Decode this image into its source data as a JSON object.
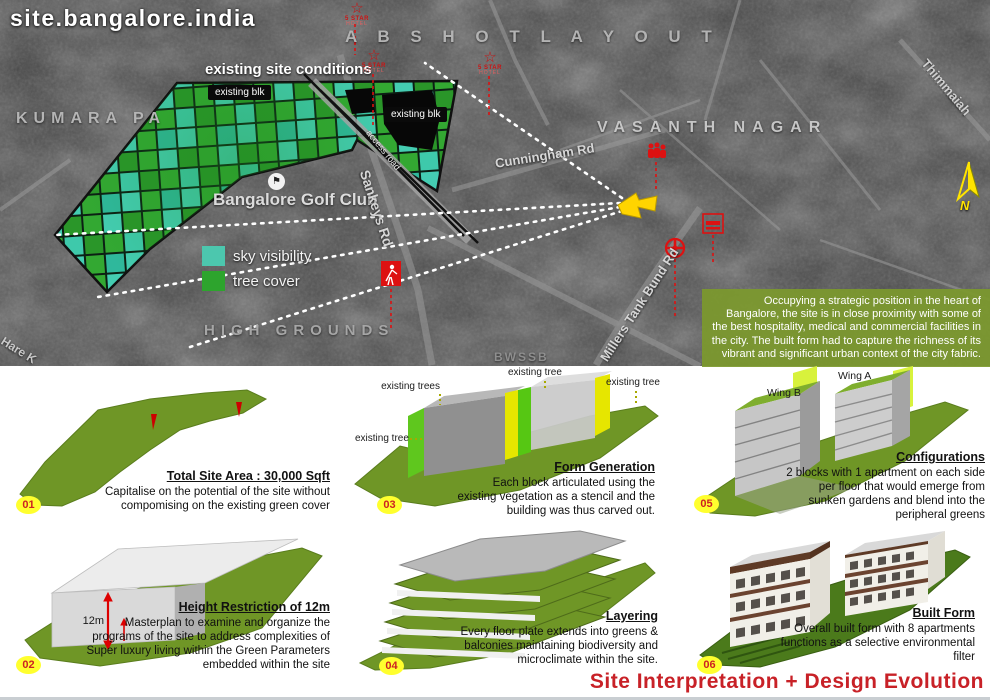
{
  "title": "site.bangalore.india",
  "map": {
    "overlay_title": "existing site conditions",
    "areas": {
      "abshot": "A B S H O T   L A Y O U T",
      "vasanth": "VASANTH NAGAR",
      "kumara": "KUMARA PA",
      "high_grounds": "HIGH GROUNDS",
      "bwssb": "BWSSB"
    },
    "roads": {
      "cunningham": "Cunningham Rd",
      "sankeys": "Sankeys Rd",
      "millers": "Millers Tank Bund Rd",
      "thimmaiah": "Thimmaiah",
      "hare": "Hare K",
      "access": "access road"
    },
    "golf_club": "Bangalore Golf Club",
    "blk1": "existing blk",
    "blk2": "existing blk",
    "legend": {
      "sky": "sky visibility",
      "tree": "tree cover"
    },
    "hotel": {
      "star": "5 STAR",
      "sub": "HOTEL"
    },
    "north": "N",
    "description": "Occupying a strategic position in the heart of Bangalore, the site is in close proximity with some of the best hospitality, medical and commercial facilities in the city. The built form had to capture the richness of its vibrant and significant urban context of the city fabric."
  },
  "diagrams": [
    {
      "num": "01",
      "heading": "Total Site Area : 30,000 Sqft",
      "body": "Capitalise on the potential of the site without compomising on the existing green cover"
    },
    {
      "num": "02",
      "heading": "Height Restriction of 12m",
      "dim": "12m",
      "body": "Masterplan to examine and organize the programs of the site to address complexities of Super luxury living within the Green Parameters embedded within the site"
    },
    {
      "num": "03",
      "heading": "Form Generation",
      "labels": [
        "existing trees",
        "existing tree",
        "existing trees",
        "existing tree"
      ],
      "body": "Each block articulated using the existing vegetation as a stencil and the building was thus carved out."
    },
    {
      "num": "04",
      "heading": "Layering",
      "body": "Every floor plate extends into greens & balconies maintaining biodiversity and microclimate within the site."
    },
    {
      "num": "05",
      "heading": "Configurations",
      "labels": {
        "wing_b": "Wing B",
        "wing_a": "Wing A"
      },
      "body": "2 blocks with 1 apartment on each side per floor that would emerge from sunken gardens and blend into the peripheral greens"
    },
    {
      "num": "06",
      "heading": "Built Form",
      "body": "Overall built form with 8 apartments functions as a selective environmental filter"
    }
  ],
  "footer_title": "Site Interpretation + Design Evolution",
  "colors": {
    "sky_visibility": "#4cc7ae",
    "tree_cover": "#2da42d",
    "site_marker": "#ffd400",
    "poi_red": "#dd1111",
    "badge_yellow": "#ffff2e",
    "accent_red": "#c82127",
    "panel_olive": "#6f9626"
  }
}
